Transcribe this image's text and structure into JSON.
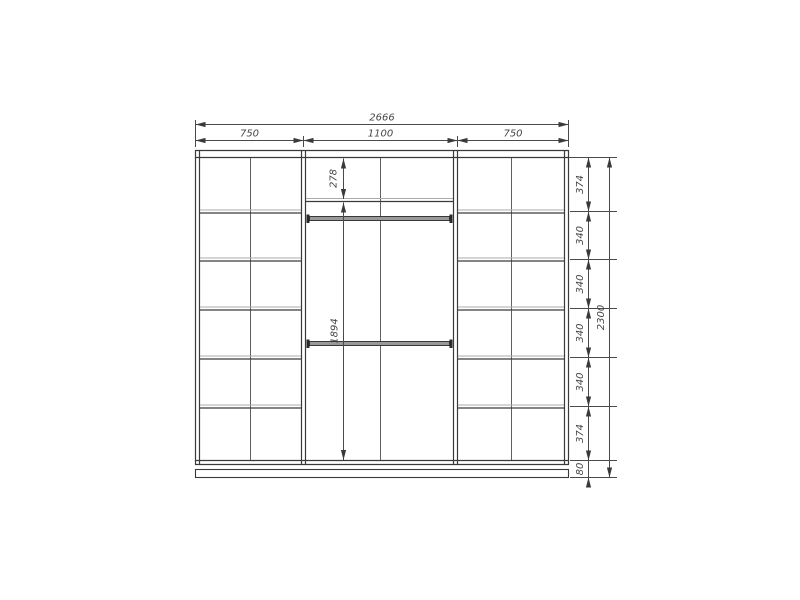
{
  "drawing": {
    "kind": "wardrobe-front-elevation-technical-drawing",
    "background_color": "#ffffff",
    "line_color": "#3a3a3a",
    "light_line_color": "#ababab",
    "dimension_color": "#454545",
    "rod_fill_color": "#999999"
  },
  "dimensions": {
    "total_width": "2666",
    "section_widths": [
      "750",
      "1100",
      "750"
    ],
    "total_height": "2300",
    "row_heights": [
      "374",
      "340",
      "340",
      "340",
      "340",
      "374",
      "80"
    ],
    "top_shelf_height": "278",
    "hanging_section_height": "1894"
  }
}
